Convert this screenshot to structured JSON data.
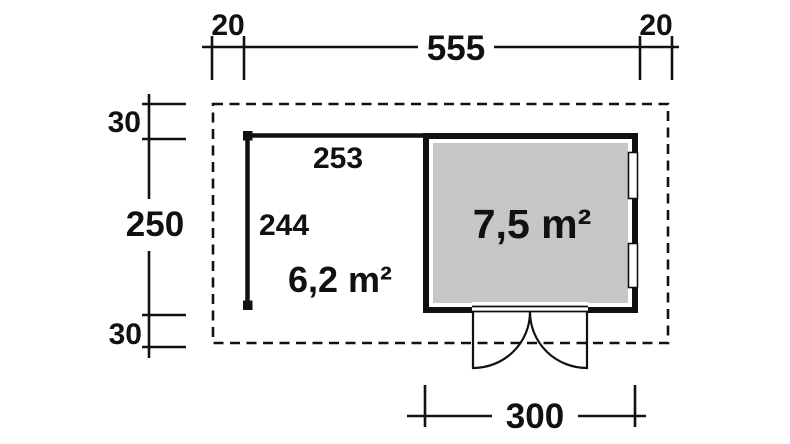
{
  "plan": {
    "top": {
      "left_overhang": "20",
      "total_width": "555",
      "right_overhang": "20"
    },
    "left": {
      "top_overhang": "30",
      "total_depth": "250",
      "bottom_overhang": "30"
    },
    "interior": {
      "width": "253",
      "depth": "244",
      "open_area": "6,2 m²",
      "room_area": "7,5 m²"
    },
    "bottom": {
      "door_width": "300"
    },
    "colors": {
      "line": "#111111",
      "room_fill": "#c6c6c6",
      "room_area_text": "#ffffff",
      "background": "#ffffff"
    }
  }
}
